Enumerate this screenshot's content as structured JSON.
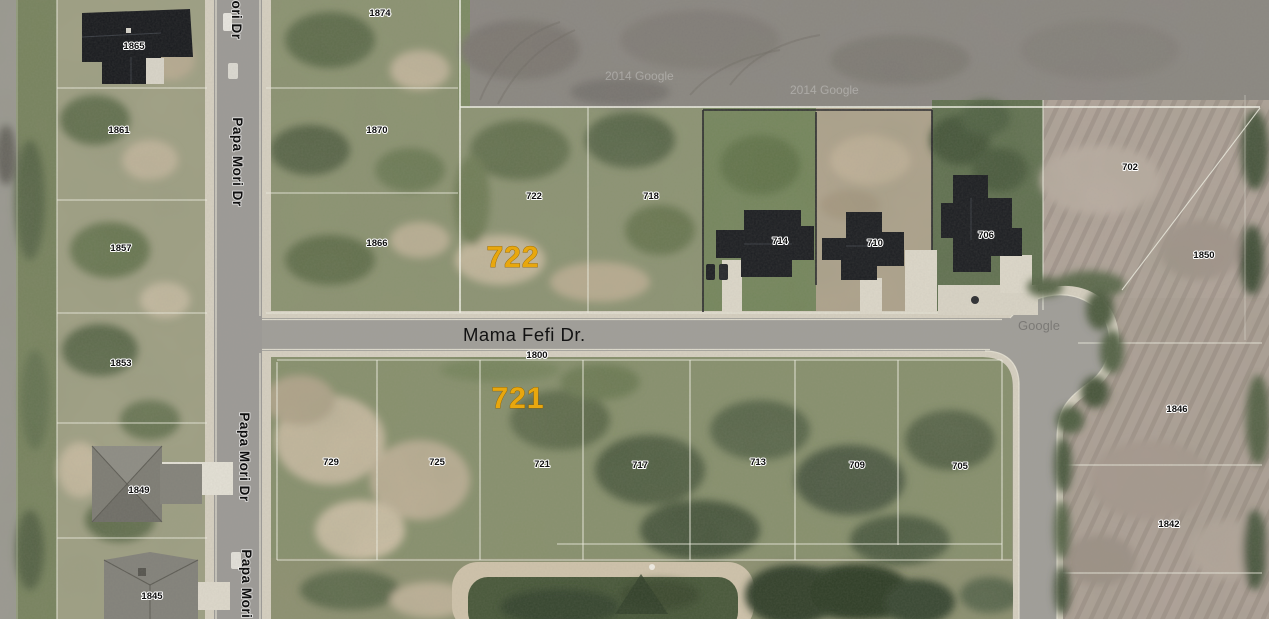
{
  "map_type": "satellite-parcel-view",
  "streets": {
    "vertical": "Papa Mori Dr",
    "vertical_partial": "ori Dr",
    "horizontal": "Mama Fefi Dr.",
    "horizontal_address": "1800"
  },
  "highlights": {
    "north_lot": "722",
    "south_lot": "721",
    "color": "#E8A70E"
  },
  "parcels": {
    "west": [
      "1865",
      "1861",
      "1857",
      "1853",
      "1849",
      "1845"
    ],
    "east_of_papa_mori": [
      "1874",
      "1870",
      "1866"
    ],
    "north_of_mama_fefi": [
      "722",
      "718",
      "714",
      "710",
      "706",
      "702"
    ],
    "south_of_mama_fefi": [
      "729",
      "725",
      "721",
      "717",
      "713",
      "709",
      "705"
    ],
    "east": [
      "1850",
      "1846",
      "1842"
    ]
  },
  "watermarks": {
    "imagery": "2014 Google",
    "logo": "Google"
  }
}
